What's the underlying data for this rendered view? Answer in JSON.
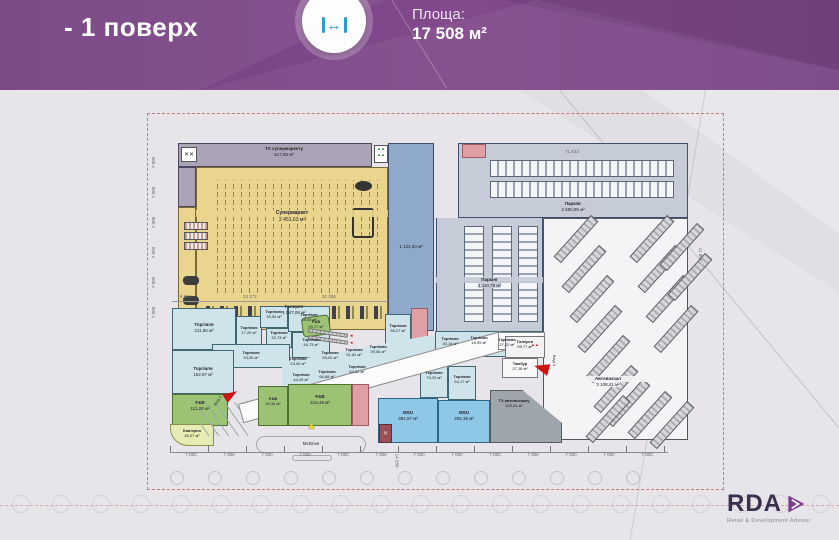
{
  "header": {
    "title": "- 1 поверх",
    "area_label": "Площа:",
    "area_value": "17 508 м²"
  },
  "footer": {
    "brand": "RDA",
    "tagline": "Retail & Development Advisor"
  },
  "palette": {
    "banner_purple": "#7b4385",
    "icon_blue": "#2d9ad6",
    "supermarket_yellow": "#e9d58d",
    "service_gray": "#aba4b6",
    "ramp_blue": "#8ea9c9",
    "parking_gray": "#c5ccd8",
    "retail_blue": "#cfe3ea",
    "fnb_green": "#9cc274",
    "msu_blue": "#8fc8e6",
    "terminal_service_gray": "#9fa5ad",
    "cafe_yellow": "#e6ecb4",
    "pink_block": "#dfa0a5",
    "axis_red": "#c75f5f",
    "logo_purple": "#7d3f8d"
  },
  "plan": {
    "zones": {
      "tx_supermarket": {
        "name": "ТХ супермаркету",
        "area": "517,59 м²"
      },
      "supermarket": {
        "name": "Супермаркет",
        "area": "2 451,63 м²"
      },
      "ramp": {
        "area": "1 124,20 м²"
      },
      "parking_top": {
        "name": "Паркінг",
        "area": "3 680,95 м²"
      },
      "parking_mid": {
        "name": "Паркінг",
        "area": "1 110,79 м²"
      },
      "bus_terminal": {
        "name": "Автовокзал",
        "area": "3 108,31 м²"
      },
      "gallery_main": {
        "name": "Галерея",
        "area": "1 047,08 м²"
      },
      "gallery_small": {
        "name": "Галерея",
        "area": "99,77 м²"
      },
      "tambour": {
        "name": "Тамбур",
        "area": "27,18 м²"
      },
      "tx_bus": {
        "name": "ТХ автовокзалу",
        "area": "320,61 м²"
      },
      "msu_1": {
        "name": "MSU",
        "area": "381,57 м²"
      },
      "msu_2": {
        "name": "MSU",
        "area": "256,36 м²"
      },
      "fnb_1": {
        "name": "F&B",
        "area": "111,29 м²"
      },
      "fnb_2": {
        "name": "F&B",
        "area": "90,34 м²"
      },
      "fnb_3": {
        "name": "F&B",
        "area": "216,48 м²"
      },
      "fnb_4": {
        "name": "F&B",
        "area": "29,77 м²"
      },
      "cafe": {
        "name": "Кав'ярня",
        "area": "45,07 м²"
      },
      "mcdrive": {
        "name": "McDrive"
      }
    },
    "retail_units": [
      {
        "name": "Торгівля",
        "area": "211,96 м²"
      },
      {
        "name": "Торгівля",
        "area": "17,29 м²"
      },
      {
        "name": "Торгівля",
        "area": "30,54 м²"
      },
      {
        "name": "Торгівля",
        "area": "32,73 м²"
      },
      {
        "name": "Торгівля",
        "area": "48,34 м²"
      },
      {
        "name": "Торгівля",
        "area": "46,73 м²"
      },
      {
        "name": "Торгівля",
        "area": "93,05 м²"
      },
      {
        "name": "Торгівля",
        "area": "152,67 м²"
      },
      {
        "name": "Торгівля",
        "area": "24,09 м²"
      },
      {
        "name": "Торгівля",
        "area": "55,00 м²"
      },
      {
        "name": "Торгівля",
        "area": "51,81 м²"
      },
      {
        "name": "Торгівля",
        "area": "39,06 м²"
      },
      {
        "name": "Торгівля",
        "area": "44,09 м²"
      },
      {
        "name": "Торгівля",
        "area": "66,88 м²"
      },
      {
        "name": "Торгівля",
        "area": "64,32 м²"
      },
      {
        "name": "Торгівля",
        "area": "55,27 м²"
      },
      {
        "name": "Торгівля",
        "area": "30,14 м²"
      },
      {
        "name": "Торгівля",
        "area": "16,99 м²"
      },
      {
        "name": "Торгівля",
        "area": "27,22 м²"
      },
      {
        "name": "Торгівля",
        "area": "73,23 м²"
      },
      {
        "name": "Торгівля",
        "area": "64,17 м²"
      }
    ],
    "markers": {
      "entrance_1": "Вхід 1",
      "entrance_2": "Вхід 2"
    },
    "dims": {
      "module": "7 000",
      "top_right": "71 833",
      "right_side": "11 802",
      "bottom_vertical": "14 280",
      "mid_row": [
        "8 861",
        "23 272",
        "32 336"
      ]
    }
  }
}
